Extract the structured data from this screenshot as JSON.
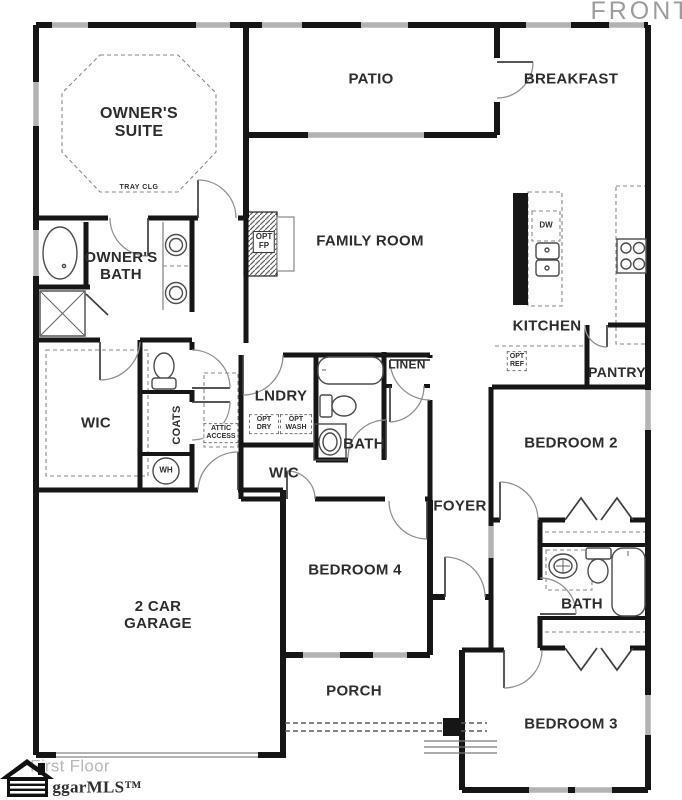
{
  "rooms": {
    "owners_suite": {
      "l1": "OWNER'S",
      "l2": "SUITE",
      "ceiling": "TRAY CLG"
    },
    "owners_bath": {
      "l1": "OWNER'S",
      "l2": "BATH"
    },
    "patio": "PATIO",
    "breakfast": "BREAKFAST",
    "family_room": "FAMILY ROOM",
    "kitchen": "KITCHEN",
    "pantry": "PANTRY",
    "linen": "LINEN",
    "laundry": "LNDRY",
    "bath": "BATH",
    "bath2": "BATH",
    "wic": "WIC",
    "wic2": "WIC",
    "coats": "COATS",
    "foyer": "FOYER",
    "bedroom2": "BEDROOM 2",
    "bedroom3": "BEDROOM 3",
    "bedroom4": "BEDROOM 4",
    "garage": {
      "l1": "2 CAR",
      "l2": "GARAGE"
    },
    "porch": "PORCH"
  },
  "annotations": {
    "front": "FRONT",
    "floor": "First Floor",
    "brand": "ggarMLS™",
    "attic": {
      "l1": "ATTIC",
      "l2": "ACCESS"
    },
    "opt_fp": {
      "l1": "OPT",
      "l2": "FP"
    },
    "opt_ref": {
      "l1": "OPT",
      "l2": "REF"
    },
    "opt_dry": {
      "l1": "OPT",
      "l2": "DRY"
    },
    "opt_wash": {
      "l1": "OPT",
      "l2": "WASH"
    },
    "dishwasher": "DW",
    "water_heater": "WH"
  },
  "colors": {
    "ink": "#2d2d2d",
    "wall": "#161616",
    "muted": "#9c9c9c",
    "win": "#b3b3b3"
  }
}
